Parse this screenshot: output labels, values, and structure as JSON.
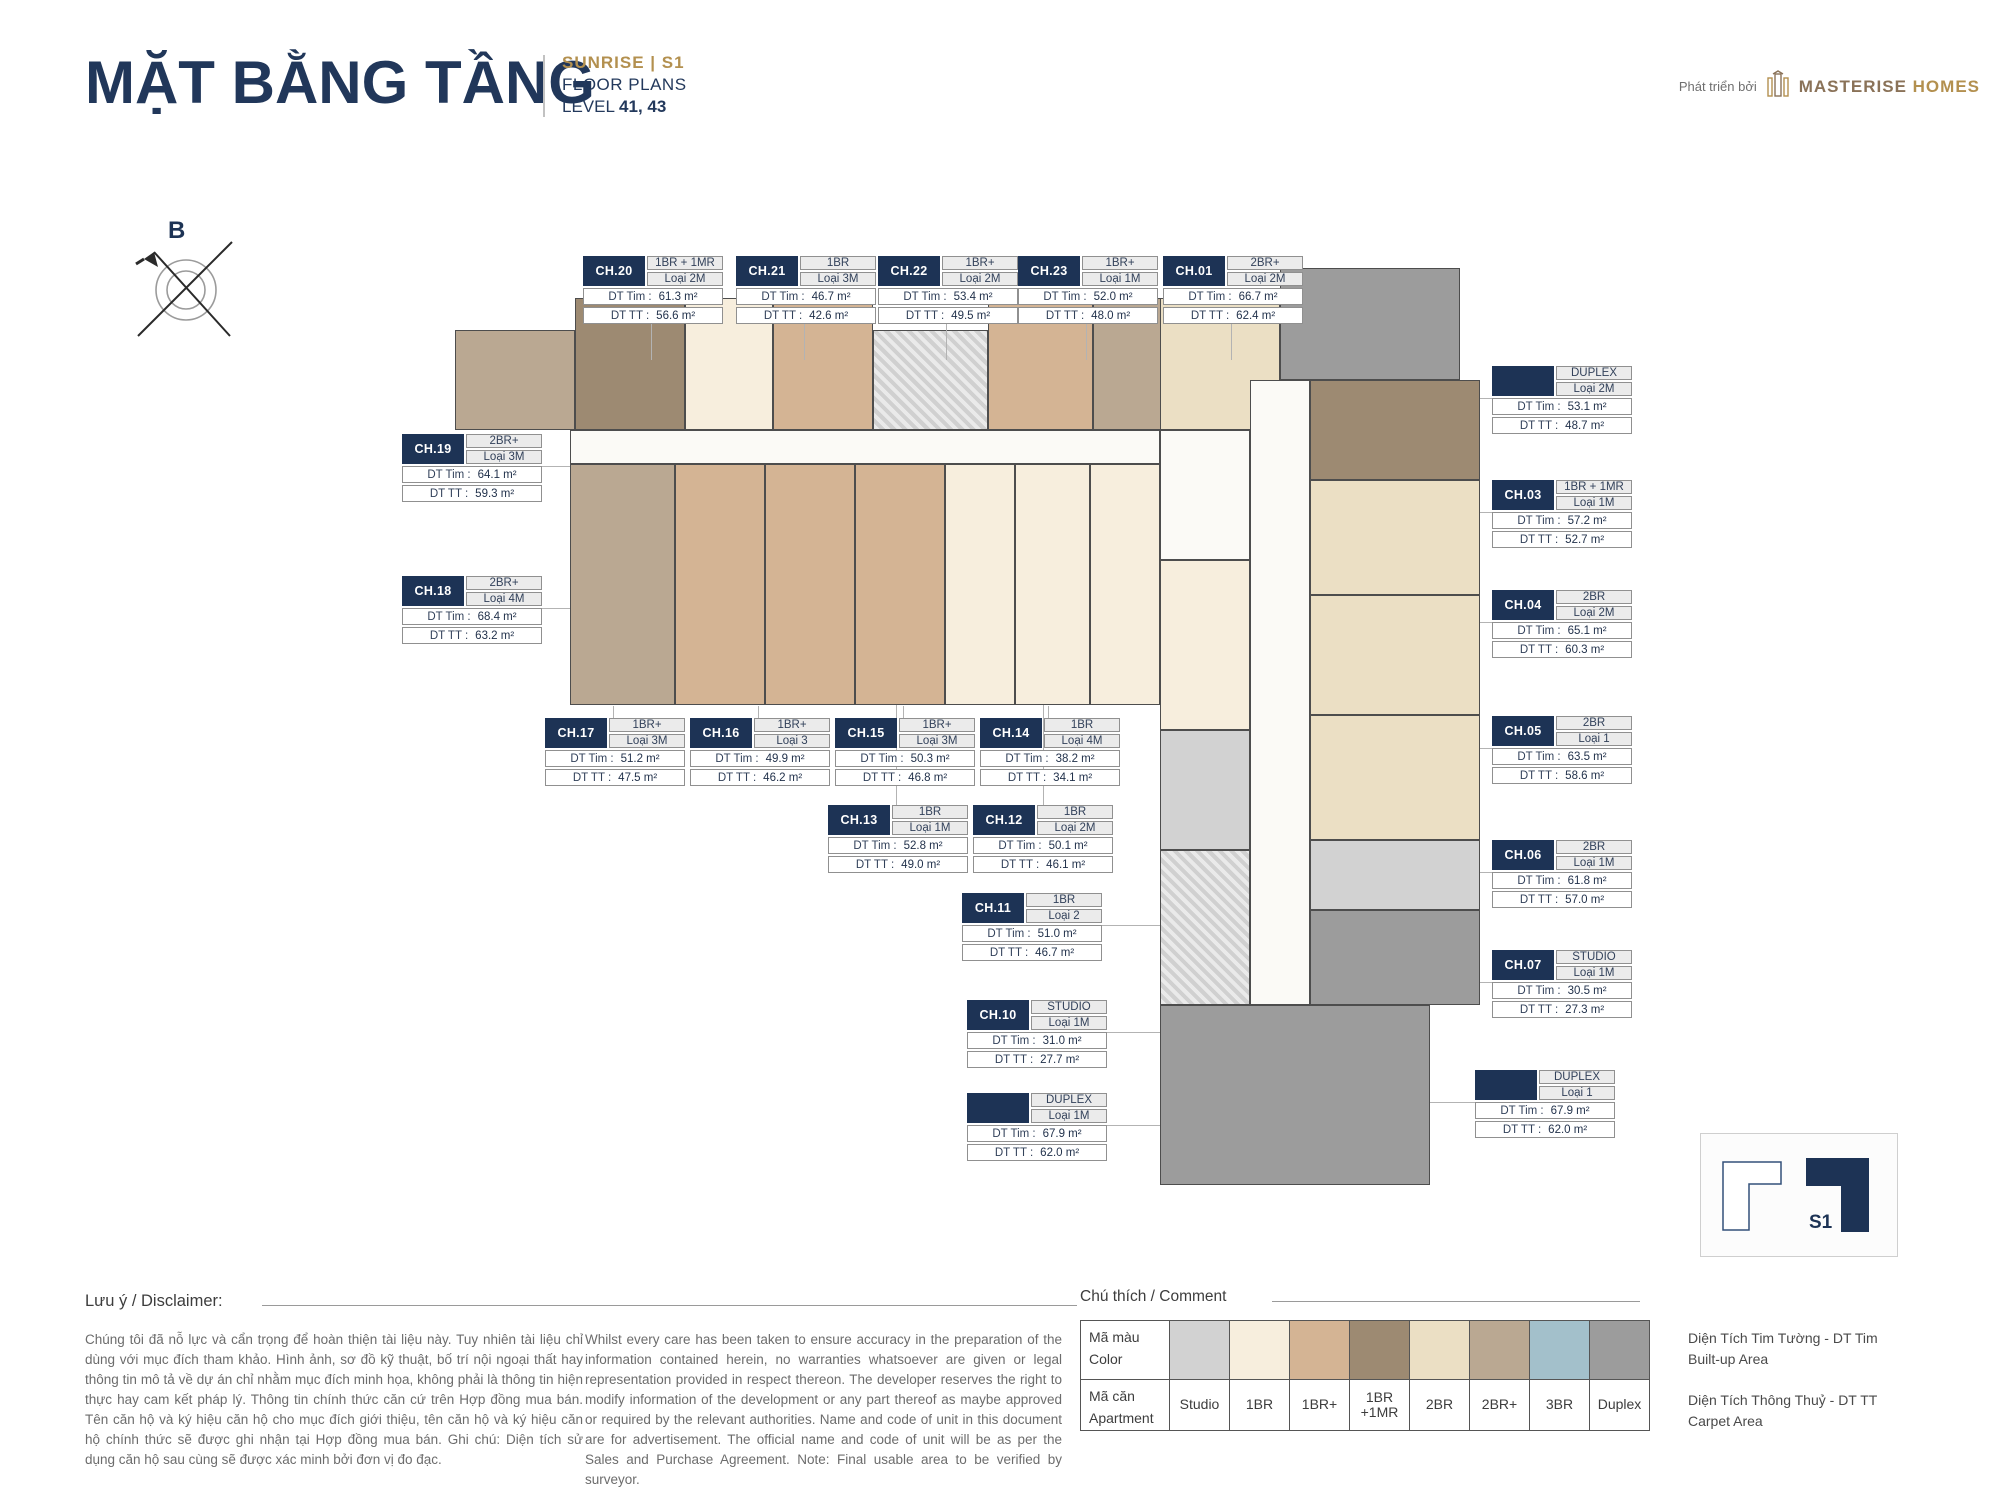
{
  "header": {
    "title": "MẶT BẰNG TẦNG",
    "project": "SUNRISE | S1",
    "subtitle": "FLOOR PLANS",
    "level_label": "LEVEL",
    "level_value": "41, 43",
    "developer_prefix": "Phát triển bởi",
    "developer_name_primary": "MASTERISE",
    "developer_name_secondary": "HOMES"
  },
  "compass": {
    "north_label": "B"
  },
  "labels": {
    "dt_tim": "DT Tim :",
    "dt_tt": "DT TT :"
  },
  "units": [
    {
      "code": "CH.20",
      "type": "1BR + 1MR",
      "variant": "Loại 2M",
      "dt_tim": "61.3 m²",
      "dt_tt": "56.6 m²"
    },
    {
      "code": "CH.21",
      "type": "1BR",
      "variant": "Loại 3M",
      "dt_tim": "46.7 m²",
      "dt_tt": "42.6 m²"
    },
    {
      "code": "CH.22",
      "type": "1BR+",
      "variant": "Loại 2M",
      "dt_tim": "53.4 m²",
      "dt_tt": "49.5 m²"
    },
    {
      "code": "CH.23",
      "type": "1BR+",
      "variant": "Loại 1M",
      "dt_tim": "52.0 m²",
      "dt_tt": "48.0 m²"
    },
    {
      "code": "CH.01",
      "type": "2BR+",
      "variant": "Loại 2M",
      "dt_tim": "66.7 m²",
      "dt_tt": "62.4 m²"
    },
    {
      "code": "CH.19",
      "type": "2BR+",
      "variant": "Loại 3M",
      "dt_tim": "64.1 m²",
      "dt_tt": "59.3 m²"
    },
    {
      "code": "CH.18",
      "type": "2BR+",
      "variant": "Loại 4M",
      "dt_tim": "68.4 m²",
      "dt_tt": "63.2 m²"
    },
    {
      "code": "",
      "type": "DUPLEX",
      "variant": "Loại 2M",
      "dt_tim": "53.1 m²",
      "dt_tt": "48.7 m²"
    },
    {
      "code": "CH.03",
      "type": "1BR + 1MR",
      "variant": "Loại 1M",
      "dt_tim": "57.2 m²",
      "dt_tt": "52.7 m²"
    },
    {
      "code": "CH.04",
      "type": "2BR",
      "variant": "Loại 2M",
      "dt_tim": "65.1 m²",
      "dt_tt": "60.3 m²"
    },
    {
      "code": "CH.05",
      "type": "2BR",
      "variant": "Loại 1",
      "dt_tim": "63.5 m²",
      "dt_tt": "58.6 m²"
    },
    {
      "code": "CH.06",
      "type": "2BR",
      "variant": "Loại 1M",
      "dt_tim": "61.8 m²",
      "dt_tt": "57.0 m²"
    },
    {
      "code": "CH.07",
      "type": "STUDIO",
      "variant": "Loại 1M",
      "dt_tim": "30.5 m²",
      "dt_tt": "27.3 m²"
    },
    {
      "code": "",
      "type": "DUPLEX",
      "variant": "Loại 1",
      "dt_tim": "67.9 m²",
      "dt_tt": "62.0 m²"
    },
    {
      "code": "CH.17",
      "type": "1BR+",
      "variant": "Loại 3M",
      "dt_tim": "51.2 m²",
      "dt_tt": "47.5 m²"
    },
    {
      "code": "CH.16",
      "type": "1BR+",
      "variant": "Loại 3",
      "dt_tim": "49.9 m²",
      "dt_tt": "46.2 m²"
    },
    {
      "code": "CH.15",
      "type": "1BR+",
      "variant": "Loại 3M",
      "dt_tim": "50.3 m²",
      "dt_tt": "46.8 m²"
    },
    {
      "code": "CH.14",
      "type": "1BR",
      "variant": "Loại 4M",
      "dt_tim": "38.2 m²",
      "dt_tt": "34.1 m²"
    },
    {
      "code": "CH.13",
      "type": "1BR",
      "variant": "Loại 1M",
      "dt_tim": "52.8 m²",
      "dt_tt": "49.0 m²"
    },
    {
      "code": "CH.12",
      "type": "1BR",
      "variant": "Loại 2M",
      "dt_tim": "50.1 m²",
      "dt_tt": "46.1 m²"
    },
    {
      "code": "CH.11",
      "type": "1BR",
      "variant": "Loại 2",
      "dt_tim": "51.0 m²",
      "dt_tt": "46.7 m²"
    },
    {
      "code": "CH.10",
      "type": "STUDIO",
      "variant": "Loại 1M",
      "dt_tim": "31.0 m²",
      "dt_tt": "27.7 m²"
    },
    {
      "code": "",
      "type": "DUPLEX",
      "variant": "Loại 1M",
      "dt_tim": "67.9 m²",
      "dt_tt": "62.0 m²"
    }
  ],
  "disclaimer": {
    "heading": "Lưu ý / Disclaimer:",
    "vi": "Chúng tôi đã nỗ lực và cẩn trọng để hoàn thiện tài liệu này. Tuy nhiên tài liệu chỉ dùng với mục đích tham khảo. Hình ảnh, sơ đồ kỹ thuật, bố trí nội ngoại thất hay thông tin mô tả về dự án chỉ nhằm mục đích minh họa, không phải là thông tin hiện thực hay cam kết pháp lý. Thông tin chính thức căn cứ trên Hợp đồng mua bán. Tên căn hộ và ký hiệu căn hộ cho mục đích giới thiệu, tên căn hộ và ký hiệu căn hộ chính thức sẽ được ghi nhận tại Hợp đồng mua bán. Ghi chú: Diện tích sử dụng căn hộ sau cùng sẽ được xác minh bởi đơn vị đo đạc.",
    "en": "Whilst every care has been taken to ensure accuracy in the preparation of the information contained herein, no warranties whatsoever are given or legal representation provided in respect thereon. The developer reserves the right to modify information of the development or any part thereof as maybe approved or required by the relevant authorities. Name and code of unit in this document are for advertisement. The official name and code of unit will be as per the Sales and Purchase Agreement. Note: Final usable area to be verified by surveyor."
  },
  "legend": {
    "heading": "Chú thích / Comment",
    "row1_label_vi": "Mã màu",
    "row1_label_en": "Color",
    "row2_label_vi": "Mã căn",
    "row2_label_en": "Apartment",
    "items": [
      {
        "label": "Studio",
        "color": "#d2d2d2"
      },
      {
        "label": "1BR",
        "color": "#f7eedd"
      },
      {
        "label": "1BR+",
        "color": "#d4b494"
      },
      {
        "label": "1BR +1MR",
        "color": "#9d8a72"
      },
      {
        "label": "2BR",
        "color": "#ebdfc4"
      },
      {
        "label": "2BR+",
        "color": "#baa892"
      },
      {
        "label": "3BR",
        "color": "#a3c0cb"
      },
      {
        "label": "Duplex",
        "color": "#9c9c9c"
      }
    ]
  },
  "area_definitions": [
    {
      "vi": "Diện Tích Tim Tường - DT Tim",
      "en": "Built-up Area"
    },
    {
      "vi": "Diện Tích Thông Thuỷ - DT TT",
      "en": "Carpet Area"
    }
  ],
  "minimap": {
    "building_label": "S1"
  },
  "colors": {
    "navy": "#1d3355",
    "gold": "#b3904f"
  }
}
